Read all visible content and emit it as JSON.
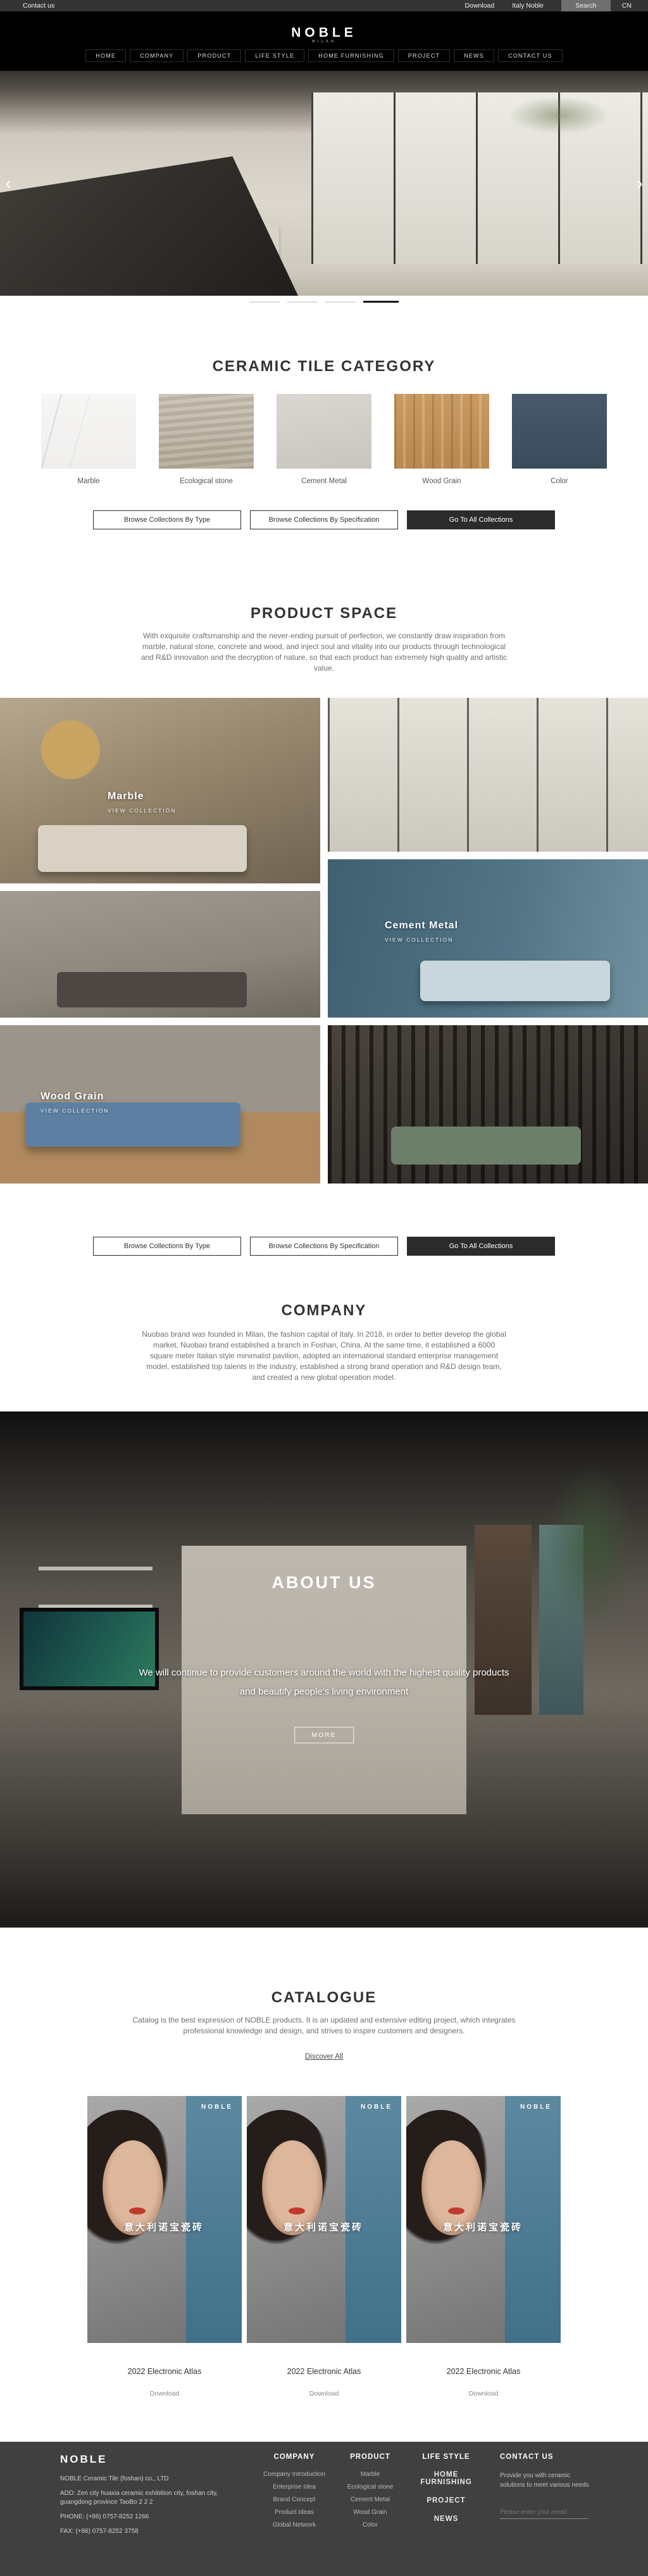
{
  "utility_bar": {
    "contact": "Contact us",
    "download": "Download",
    "italy": "Italy Noble",
    "search_label": "Search",
    "lang": "CN"
  },
  "header": {
    "logo": "NOBLE",
    "logo_sub": "MILAN",
    "nav": [
      "HOME",
      "COMPANY",
      "PRODUCT",
      "LIFE STYLE",
      "HOME FURNISHING",
      "PROJECT",
      "NEWS",
      "CONTACT US"
    ]
  },
  "hero": {
    "prev": "‹",
    "next": "›",
    "total_slides": 4,
    "active_slide": 4
  },
  "category": {
    "title": "CERAMIC TILE CATEGORY",
    "items": [
      {
        "label": "Marble"
      },
      {
        "label": "Ecological stone"
      },
      {
        "label": "Cement Metal"
      },
      {
        "label": "Wood Grain"
      },
      {
        "label": "Color"
      }
    ]
  },
  "collection_buttons": {
    "by_type": "Browse Collections By Type",
    "by_spec": "Browse Collections By Specification",
    "all": "Go To All Collections"
  },
  "product_space": {
    "title": "PRODUCT SPACE",
    "description": "With exquisite craftsmanship and the never-ending pursuit of perfection, we constantly draw inspiration from marble, natural stone, concrete and wood, and inject soul and vitality into our products through technological and R&D innovation and the decryption of nature, so that each product has extremely high quality and artistic value.",
    "tiles": [
      {
        "name": "Marble",
        "cta": "VIEW COLLECTION"
      },
      {
        "name": "Cement Metal",
        "cta": "VIEW COLLECTION"
      },
      {
        "name": "Wood Grain",
        "cta": "VIEW COLLECTION"
      }
    ]
  },
  "company": {
    "title": "COMPANY",
    "description": "Nuobao brand was founded in Milan, the fashion capital of Italy. In 2018, in order to better develop the global market, Nuobao brand established a branch in Foshan, China. At the same time, it established a 6000 square meter Italian style minimalist pavilion, adopted an international standard enterprise management model, established top talents in the industry, established a strong brand operation and R&D design team, and created a new global operation model."
  },
  "about": {
    "title": "ABOUT US",
    "tagline_line1": "We will continue to provide customers around the world with the highest quality products",
    "tagline_line2": "and beautify people's living environment",
    "more_label": "MORE"
  },
  "catalogue": {
    "title": "CATALOGUE",
    "description": "Catalog is the best expression of NOBLE products. It is an updated and extensive editing project, which integrates professional knowledge and design, and strives to inspire customers and designers.",
    "discover": "Discover All",
    "cover_brand": "NOBLE",
    "cover_text": "意大利诺宝瓷砖",
    "items": [
      {
        "title": "2022 Electronic Atlas",
        "download": "Download"
      },
      {
        "title": "2022 Electronic Atlas",
        "download": "Download"
      },
      {
        "title": "2022 Electronic Atlas",
        "download": "Download"
      }
    ]
  },
  "footer": {
    "brand": "NOBLE",
    "company_name": "NOBLE Ceramic Tile (foshan) co., LTD",
    "address": "ADD:  Zen city huaxia ceramic exhibition city, foshan city, guangdong province TaoBo 2 2 2",
    "phone": "PHONE:   (+86)  0757-8252 1266",
    "fax": "FAX:   (+86)  0757-8252 3758",
    "columns": [
      {
        "heading": "COMPANY",
        "links": [
          "Company Introduction",
          "Enterprise Idea",
          "Brand Concept",
          "Product Ideas",
          "Global Network"
        ]
      },
      {
        "heading": "PRODUCT",
        "links": [
          "Marble",
          "Ecological stone",
          "Cement Metal",
          "Wood Grain",
          "Color"
        ]
      },
      {
        "heading": "LIFE STYLE",
        "links": [
          "HOME FURNISHING",
          "PROJECT",
          "NEWS"
        ]
      }
    ],
    "contact": {
      "heading": "CONTACT US",
      "text": "Provide you with ceramic solutions to meet various needs",
      "email_placeholder": "Please enter your email"
    }
  },
  "colors": {
    "accent_dark": "#2b2b2b",
    "footer_bg": "#404040",
    "utility_bg": "#343434",
    "color_swatch_blue": "#3f5162",
    "cover_panel_blue": "#4e7d97"
  }
}
